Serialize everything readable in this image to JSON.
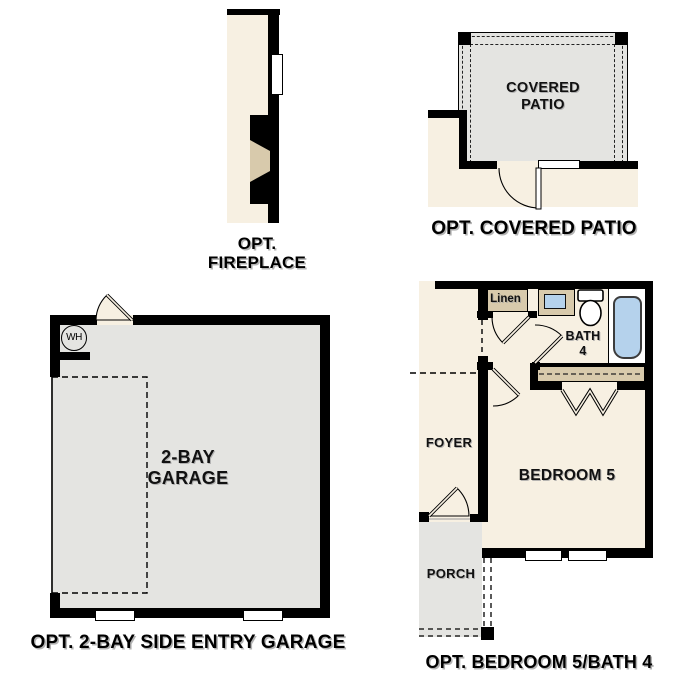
{
  "figure": "floor-plan-options-sheet",
  "palette": {
    "wall": "#000000",
    "interior_cream": "#f7f0e2",
    "floor_gray": "#e4e4e1",
    "fixture_tan": "#d8caac",
    "fixture_blue": "#b5d2ec",
    "background": "#ffffff"
  },
  "plans": {
    "fireplace": {
      "caption_lines": [
        "OPT.",
        "FIREPLACE"
      ]
    },
    "covered_patio": {
      "room_label_lines": [
        "COVERED",
        "PATIO"
      ],
      "caption": "OPT. COVERED PATIO"
    },
    "garage": {
      "room_label_lines": [
        "2-BAY",
        "GARAGE"
      ],
      "water_heater_label": "WH",
      "caption": "OPT. 2-BAY SIDE ENTRY GARAGE"
    },
    "bedroom_bath": {
      "linen_label": "Linen",
      "bath_label_lines": [
        "BATH",
        "4"
      ],
      "foyer_label": "FOYER",
      "bedroom_label": "BEDROOM 5",
      "porch_label": "PORCH",
      "caption": "OPT. BEDROOM 5/BATH 4"
    }
  }
}
